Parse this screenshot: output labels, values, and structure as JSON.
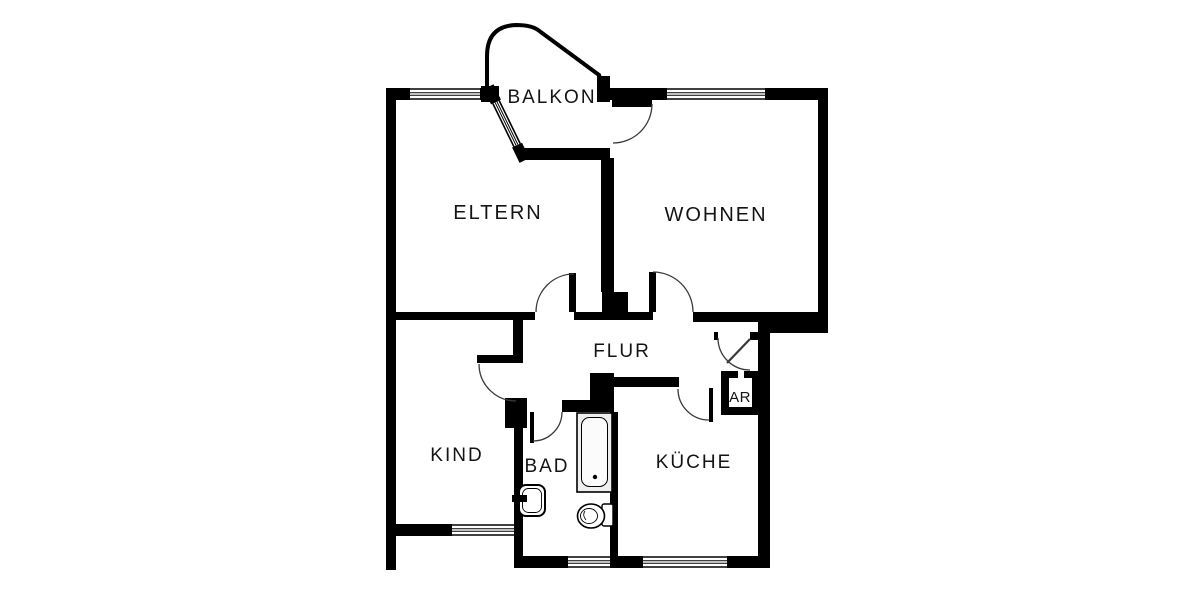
{
  "page": {
    "background": "#ffffff"
  },
  "colors": {
    "wall": "#000000",
    "door_arc": "#3a3a3a",
    "window_line": "#000000",
    "fixture_fill": "#efefef"
  },
  "rooms": {
    "balkon": "BALKON",
    "eltern": "ELTERN",
    "wohnen": "WOHNEN",
    "flur": "FLUR",
    "kind": "KIND",
    "bad": "BAD",
    "kueche": "KÜCHE",
    "ar": "AR"
  }
}
